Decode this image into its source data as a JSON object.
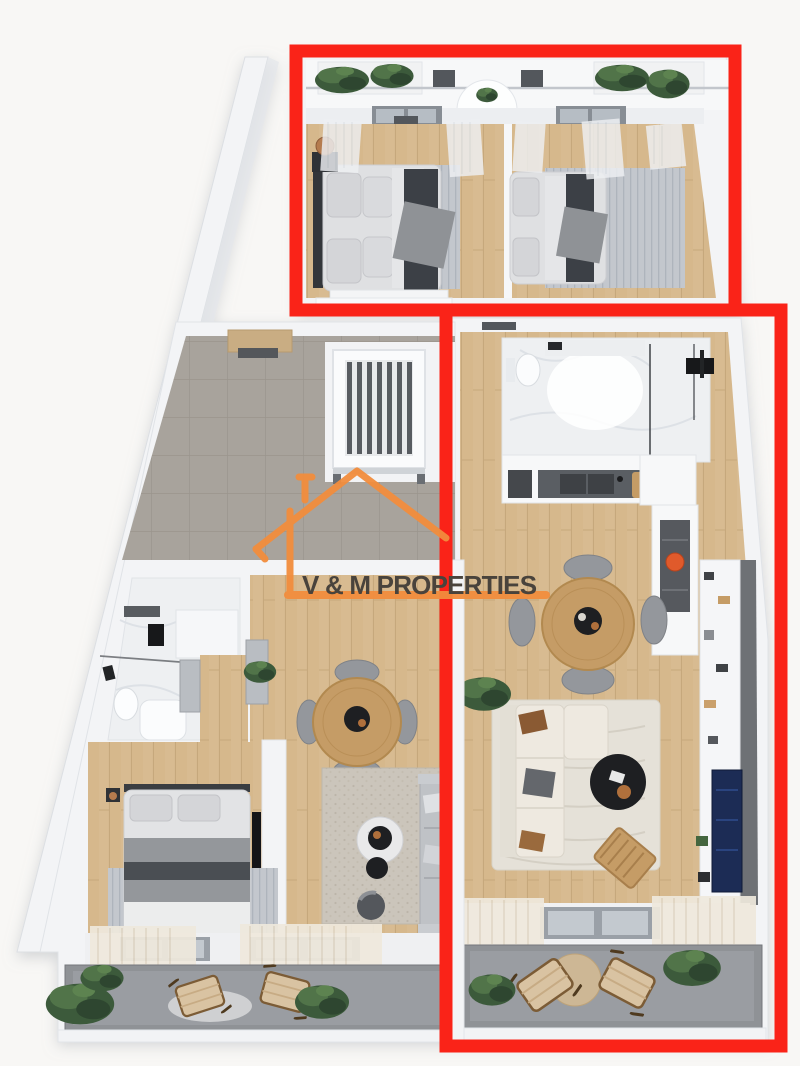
{
  "watermark": {
    "text": "V & M PROPERTIES",
    "logo": "house-outline-icon",
    "text_color": "#49433c",
    "accent_color": "#f28d3d"
  },
  "highlights": {
    "color": "#fa2318",
    "border_width": 13,
    "boxes": [
      {
        "name": "top-bedrooms-suite",
        "x": 296,
        "y": 51,
        "width": 439,
        "height": 259
      },
      {
        "name": "right-apartment",
        "x": 446,
        "y": 310,
        "width": 335,
        "height": 736
      }
    ]
  },
  "scene": {
    "type": "3d-floor-plan-render",
    "areas": [
      "upper-balcony",
      "bedroom-top-left",
      "bedroom-top-right",
      "stair-hall",
      "right-bathroom",
      "kitchen",
      "dining-right",
      "living-right",
      "right-balcony",
      "left-bathroom",
      "wardrobe-corridor",
      "bedroom-left",
      "dining-left",
      "living-left",
      "left-balcony"
    ]
  },
  "palette": {
    "background": "#f8f7f5",
    "wall": "#f3f4f6",
    "wall_edge": "#dcdfe3",
    "wood_floor": "#d8bb91",
    "tile_floor": "#a8a39c",
    "marble": "#eef0f2",
    "balcony_floor": "#8f9296",
    "rug_gray": "#c3c7cd",
    "rug_cream": "#e5e1d8",
    "bed_linen": "#e0e1e3",
    "throw_dark": "#3c4046",
    "sofa_cream": "#eee9e0",
    "table_wood": "#c59c66",
    "table_black": "#1e1f22",
    "chair_gray": "#94979c",
    "curtain_cream": "#efe9dd",
    "plant_green": "#3c5a3b",
    "tv_screen_blue": "#1c2c55",
    "pot_orange": "#e05a2b"
  }
}
